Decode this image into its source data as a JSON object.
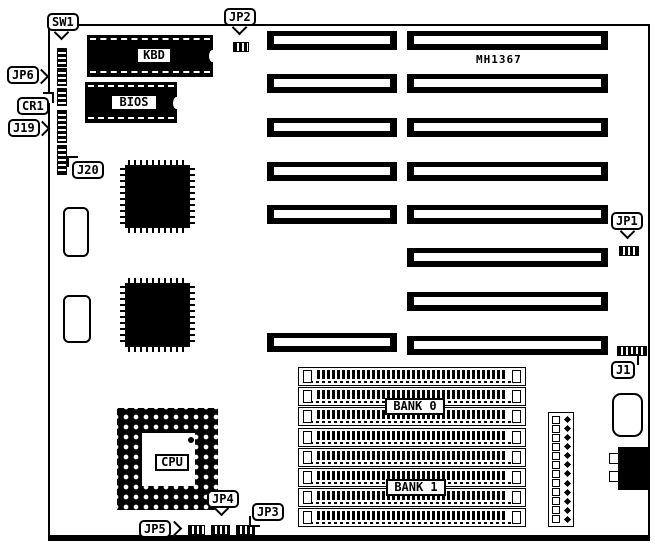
{
  "diagram": {
    "type": "motherboard-jumper-diagram",
    "model_text": "MH1367",
    "colors": {
      "ink": "#000000",
      "paper": "#ffffff"
    },
    "callouts": [
      {
        "id": "sw1",
        "text": "SW1"
      },
      {
        "id": "jp2",
        "text": "JP2"
      },
      {
        "id": "jp6",
        "text": "JP6"
      },
      {
        "id": "cr1",
        "text": "CR1"
      },
      {
        "id": "j19",
        "text": "J19"
      },
      {
        "id": "j20",
        "text": "J20"
      },
      {
        "id": "jp1",
        "text": "JP1"
      },
      {
        "id": "j1",
        "text": "J1"
      },
      {
        "id": "jp4",
        "text": "JP4"
      },
      {
        "id": "jp5",
        "text": "JP5"
      },
      {
        "id": "jp3",
        "text": "JP3"
      }
    ],
    "chip_labels": {
      "keyboard": "KBD",
      "bios": "BIOS",
      "cpu": "CPU"
    },
    "memory_banks": {
      "bank0": "BANK 0",
      "bank1": "BANK 1"
    },
    "counts": {
      "isa_slots_left_column": 6,
      "isa_slots_right_column": 8,
      "simm_sockets": 8,
      "power_header_pins": 12
    }
  }
}
